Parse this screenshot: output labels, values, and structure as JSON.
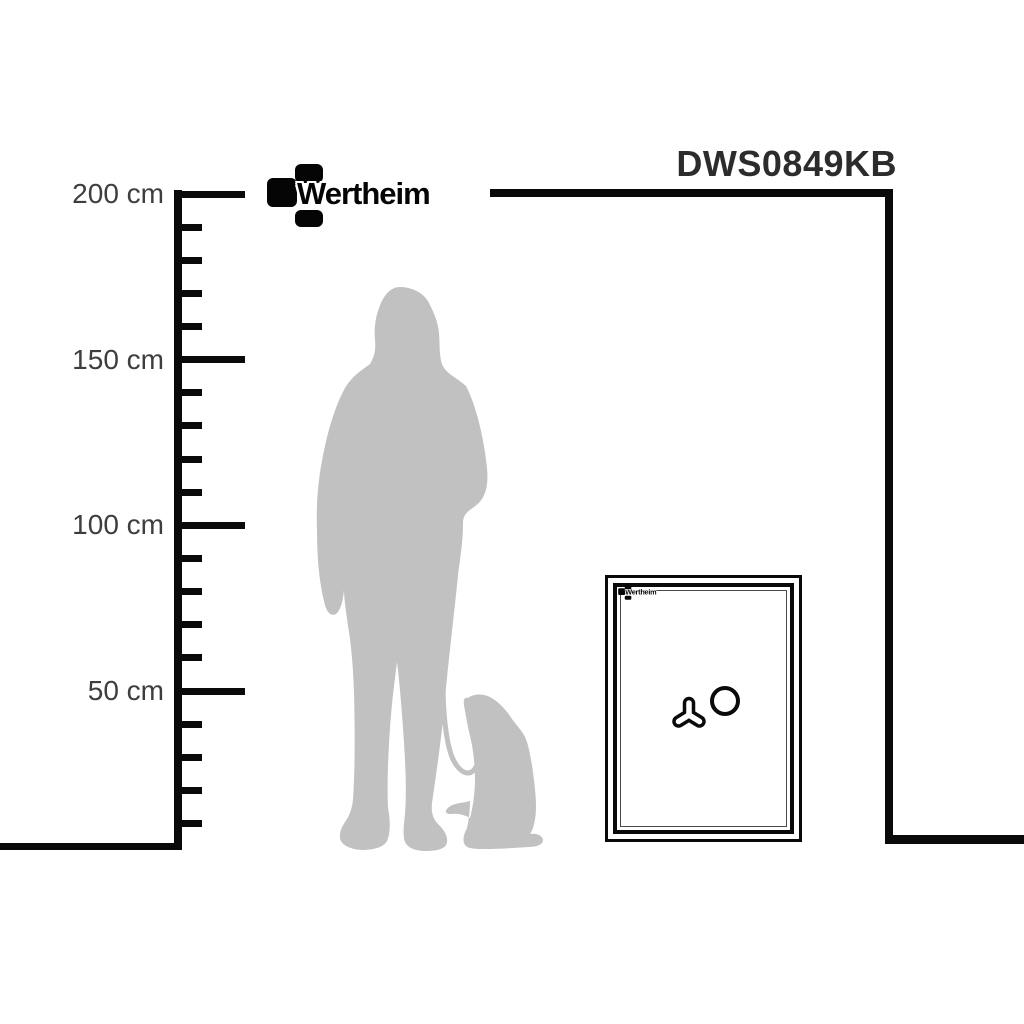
{
  "product": {
    "model": "DWS0849KB"
  },
  "brand": {
    "name": "Wertheim"
  },
  "ruler": {
    "unit": "cm",
    "ticks": [
      {
        "cm": 200,
        "major": true,
        "label": "200 cm"
      },
      {
        "cm": 190,
        "major": false,
        "label": ""
      },
      {
        "cm": 180,
        "major": false,
        "label": ""
      },
      {
        "cm": 170,
        "major": false,
        "label": ""
      },
      {
        "cm": 160,
        "major": false,
        "label": ""
      },
      {
        "cm": 150,
        "major": true,
        "label": "150 cm"
      },
      {
        "cm": 140,
        "major": false,
        "label": ""
      },
      {
        "cm": 130,
        "major": false,
        "label": ""
      },
      {
        "cm": 120,
        "major": false,
        "label": ""
      },
      {
        "cm": 110,
        "major": false,
        "label": ""
      },
      {
        "cm": 100,
        "major": true,
        "label": "100 cm"
      },
      {
        "cm": 90,
        "major": false,
        "label": ""
      },
      {
        "cm": 80,
        "major": false,
        "label": ""
      },
      {
        "cm": 70,
        "major": false,
        "label": ""
      },
      {
        "cm": 60,
        "major": false,
        "label": ""
      },
      {
        "cm": 50,
        "major": true,
        "label": "50 cm"
      },
      {
        "cm": 40,
        "major": false,
        "label": ""
      },
      {
        "cm": 30,
        "major": false,
        "label": ""
      },
      {
        "cm": 20,
        "major": false,
        "label": ""
      },
      {
        "cm": 10,
        "major": false,
        "label": ""
      }
    ]
  },
  "figures": {
    "person": "woman-with-long-hair-silhouette",
    "dog": "sitting-dog-silhouette",
    "leash": "dog-leash"
  },
  "colors": {
    "line": "#0a0a0a",
    "title_text": "#2c2c2c",
    "label_text": "#3e3e3e",
    "silhouette": "#c1c1c1",
    "background": "#ffffff"
  }
}
